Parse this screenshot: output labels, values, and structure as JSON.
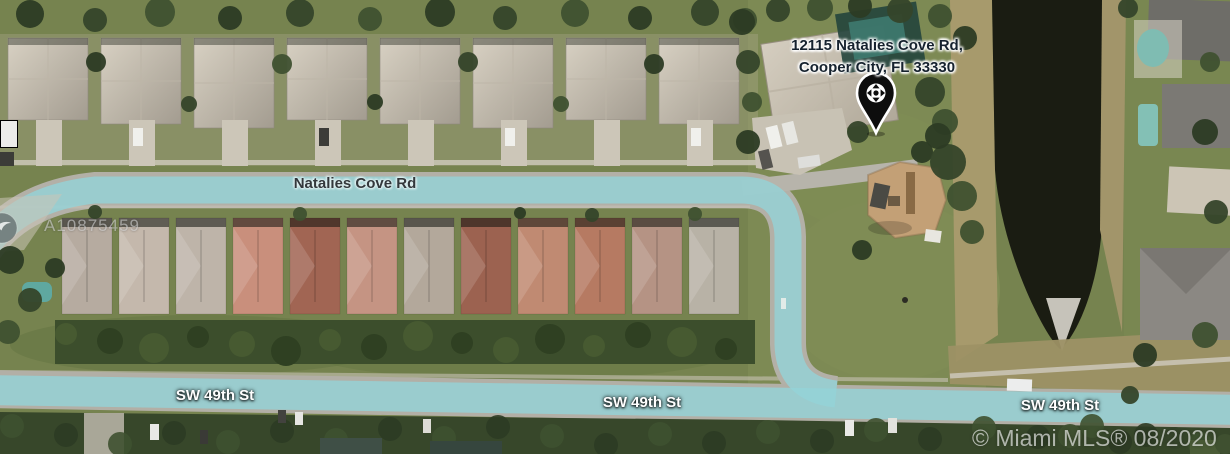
{
  "map": {
    "marker": {
      "address_line1": "12115 Natalies Cove Rd,",
      "address_line2": "Cooper City, FL 33330",
      "pin_icon": "location-pin-with-move-arrows"
    },
    "streets": {
      "natalies_cove_rd": "Natalies Cove Rd",
      "sw_49th_st_left": "SW 49th St",
      "sw_49th_st_center": "SW 49th St",
      "sw_49th_st_right": "SW 49th St"
    },
    "watermark": {
      "listing_id": "A10875459"
    },
    "attribution": "© Miami MLS® 08/2020",
    "colors": {
      "route_highlight": "#94d3d8",
      "road_gray": "#b3b0a7",
      "address_text": "#16222e",
      "street_label_dark": "#33383c",
      "street_label_light": "#ffffff",
      "pin_fill": "#0d0d0d",
      "canal_water": "#1a1c12",
      "grass": "#76834f"
    }
  }
}
